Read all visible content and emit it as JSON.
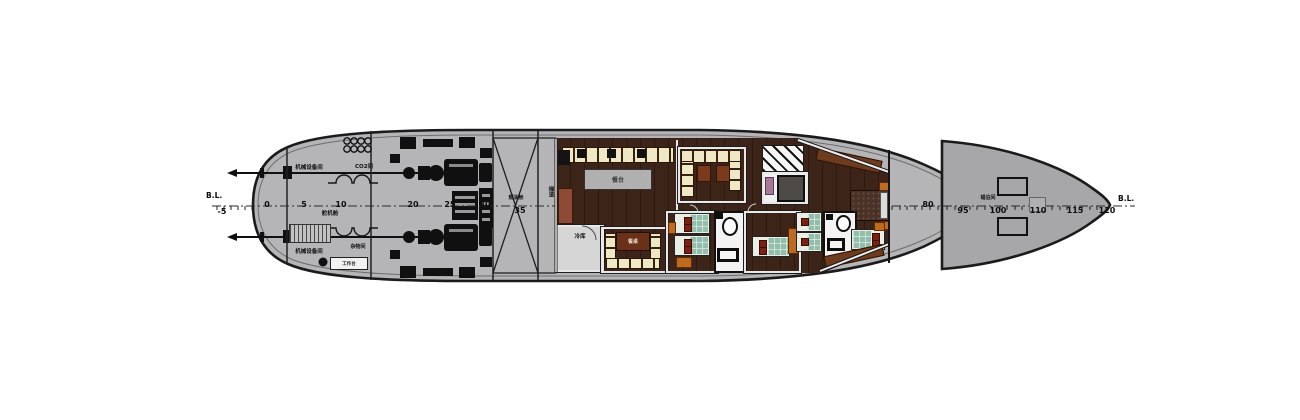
{
  "drawing": {
    "baseline_left": "B.L.",
    "baseline_right": "B.L.",
    "stations": [
      "-5",
      "0",
      "5",
      "10",
      "20",
      "25",
      "30",
      "35",
      "80",
      "95",
      "100",
      "110",
      "115",
      "120"
    ],
    "rooms": {
      "machinery_room_top": "机械设备间",
      "co2_room": "CO2间",
      "steering_gear": "舵机舱",
      "machinery_room_bottom": "机械设备间",
      "store_room": "杂物间",
      "workbench": "工作台",
      "tank": "燃油舱",
      "stair_lobby": "梯道",
      "galley_counter": "餐台",
      "cold_store": "冷库",
      "mess_table": "餐桌",
      "anchor_room": "锚泊间"
    },
    "colors": {
      "hull": "#b5b5b7",
      "bow_section": "#a7a7a9",
      "outline": "#1b1b1b",
      "wood_floor": "#3d2418",
      "counter_cream": "#efe8c4",
      "furniture_brown": "#6e3b1d",
      "bed_green": "#92bfab",
      "pillow_red": "#7c2014",
      "nightstand_orange": "#bf6a1f"
    }
  }
}
